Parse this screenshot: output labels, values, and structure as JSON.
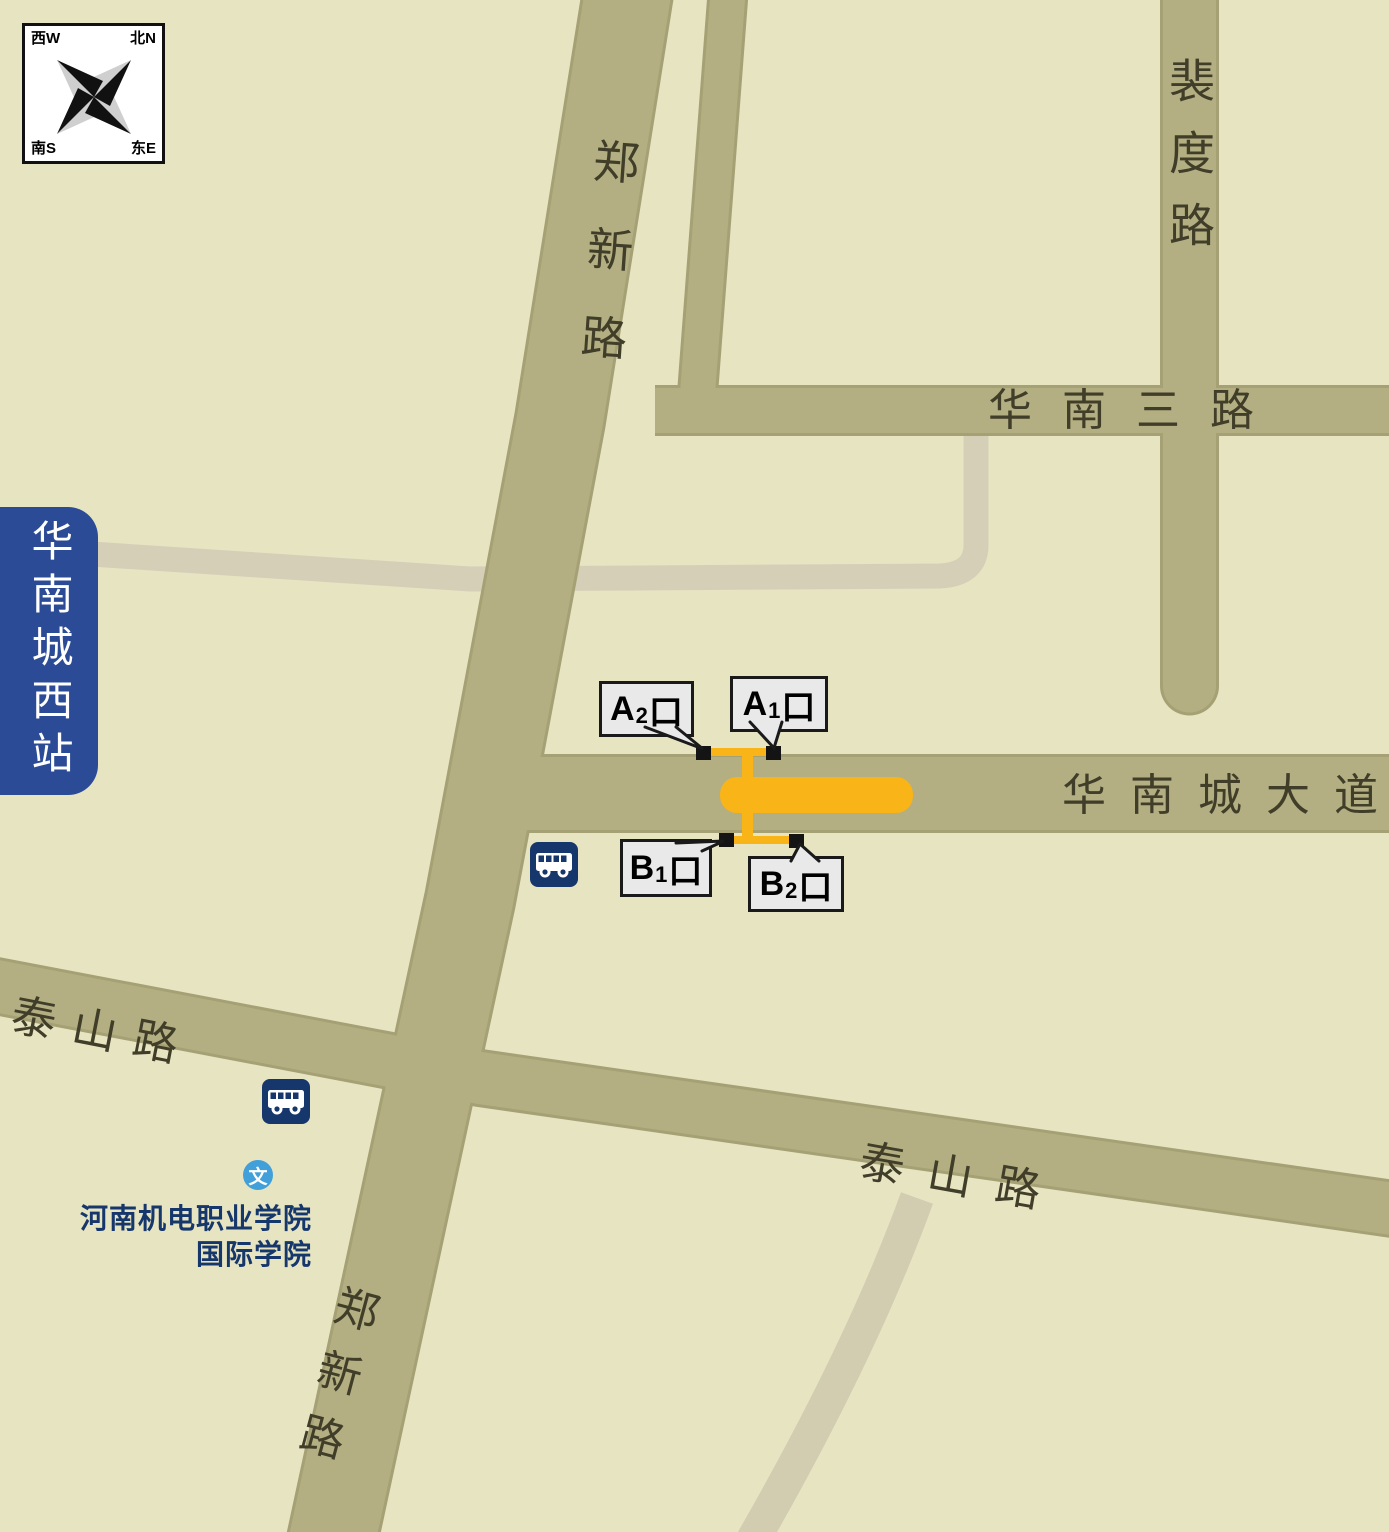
{
  "colors": {
    "background": "#e7e4c2",
    "road": "#b3af82",
    "road_edge": "#a5a175",
    "minor_road": "#d5cfb8",
    "station_orange": "#f9b418",
    "plate_blue": "#2b4b97",
    "poi_navy": "#16376b",
    "school_icon_blue": "#41a0d9",
    "callout_bg": "#e9e9e9"
  },
  "compass": {
    "nw": "西W",
    "ne": "北N",
    "sw": "南S",
    "se": "东E"
  },
  "station": {
    "name": "华南城西站"
  },
  "roads": {
    "zhengxin": "郑新路",
    "peidu": "裴度路",
    "huanan3": "华南三路",
    "huanancheng": "华南城大道",
    "taishan": "泰山路"
  },
  "exits": {
    "a2": {
      "letter": "A",
      "number": "2",
      "suffix": "口"
    },
    "a1": {
      "letter": "A",
      "number": "1",
      "suffix": "口"
    },
    "b1": {
      "letter": "B",
      "number": "1",
      "suffix": "口"
    },
    "b2": {
      "letter": "B",
      "number": "2",
      "suffix": "口"
    }
  },
  "poi": {
    "school_line1": "河南机电职业学院",
    "school_line2": "国际学院",
    "school_icon": "文"
  }
}
